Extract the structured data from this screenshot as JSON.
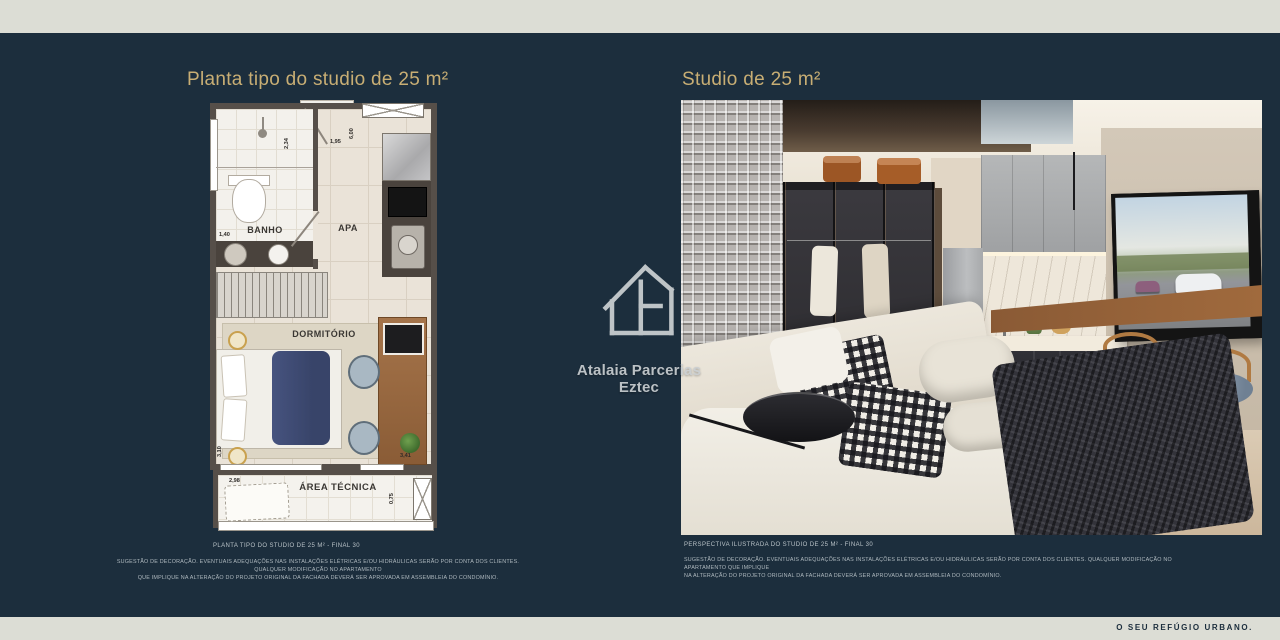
{
  "colors": {
    "background_navy": "#1c2e3d",
    "band_cream": "#dcddd5",
    "accent_gold": "#c8ae74",
    "caption_gray": "#b9c2c7",
    "plan_wall": "#564f49",
    "plan_floor": "#eae3d8"
  },
  "header": {
    "left_title": "Planta tipo do studio de 25 m²",
    "right_title": "Studio de 25 m²"
  },
  "floorplan": {
    "rooms": {
      "banho": "BANHO",
      "apa": "APA",
      "dormitorio": "DORMITÓRIO",
      "area_tecnica": "ÁREA TÉCNICA"
    },
    "dims": {
      "d234": "2,34",
      "d195": "1,95",
      "d600": "6,00",
      "d140": "1,40",
      "d310": "3,10",
      "d341": "3,41",
      "d298": "2,98",
      "d075": "0,75"
    }
  },
  "captions": {
    "plan_caption": "PLANTA TIPO DO STUDIO DE 25 M² - FINAL 30",
    "plan_disclaimer_1": "SUGESTÃO DE DECORAÇÃO. EVENTUAIS ADEQUAÇÕES NAS INSTALAÇÕES ELÉTRICAS E/OU HIDRÁULICAS SERÃO POR CONTA DOS CLIENTES. QUALQUER MODIFICAÇÃO NO APARTAMENTO",
    "plan_disclaimer_2": "QUE IMPLIQUE NA ALTERAÇÃO DO PROJETO ORIGINAL DA FACHADA DEVERÁ SER APROVADA EM ASSEMBLEIA DO CONDOMÍNIO.",
    "photo_caption": "PERSPECTIVA ILUSTRADA DO STUDIO DE 25 M² - FINAL 30",
    "photo_disclaimer_1": "SUGESTÃO DE DECORAÇÃO. EVENTUAIS ADEQUAÇÕES NAS INSTALAÇÕES ELÉTRICAS E/OU HIDRÁULICAS SERÃO POR CONTA DOS CLIENTES. QUALQUER MODIFICAÇÃO NO APARTAMENTO QUE IMPLIQUE",
    "photo_disclaimer_2": "NA ALTERAÇÃO DO PROJETO ORIGINAL DA FACHADA DEVERÁ SER APROVADA EM ASSEMBLEIA DO CONDOMÍNIO."
  },
  "watermark": {
    "brand": "Atalaia Parcerias Eztec"
  },
  "footer": {
    "tagline": "O SEU REFÚGIO URBANO."
  }
}
